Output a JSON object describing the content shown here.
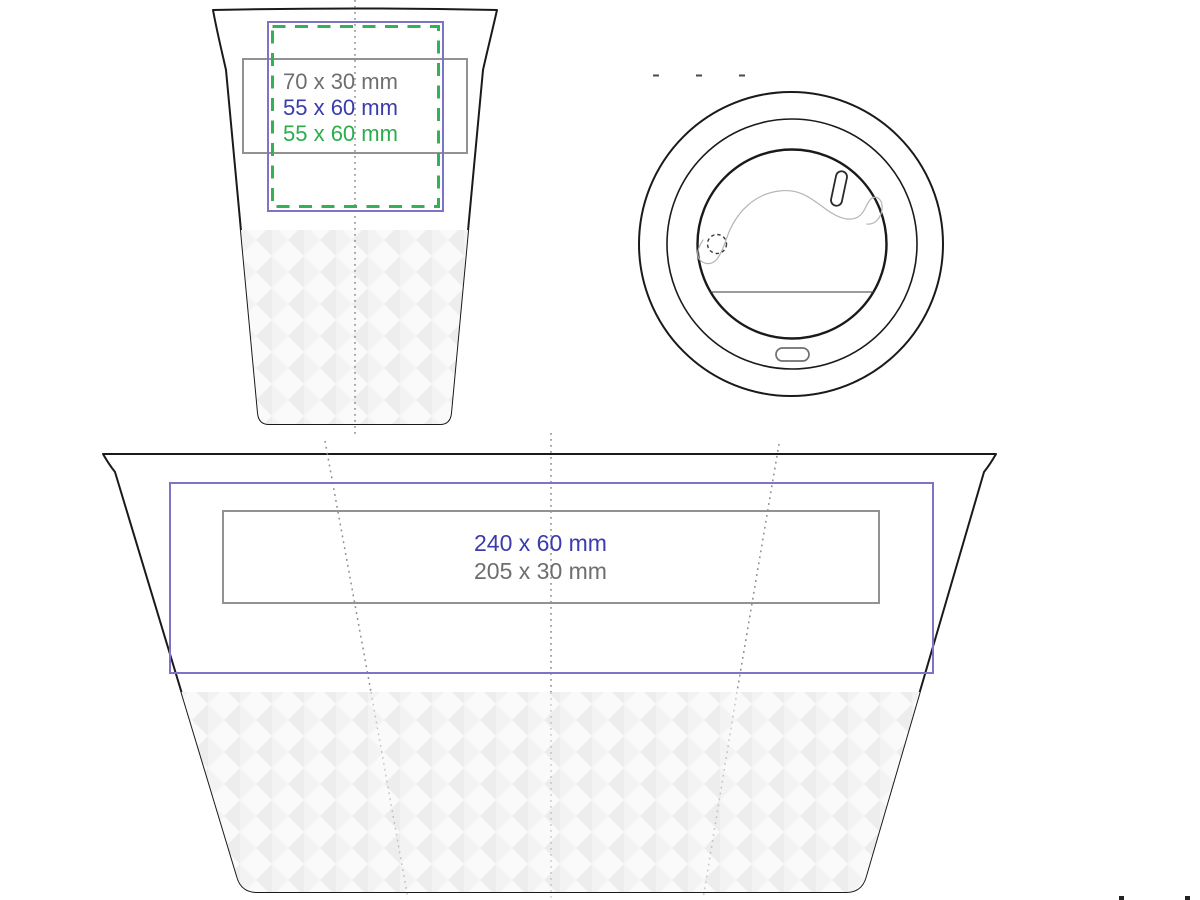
{
  "document": {
    "background": "#ffffff",
    "description_labels_only": true
  },
  "colors": {
    "outline": "#1a1a1a",
    "guide": "#8a8a8a",
    "area_gray": "#929292",
    "area_blue": "#7b74c9",
    "area_green": "#35b155",
    "text_gray": "#6e6e6e",
    "text_blue": "#3b3bae",
    "text_green": "#2bad4e",
    "detail_light": "#b5b5b5",
    "pattern_gray": "#ededed"
  },
  "front_view": {
    "labels": [
      {
        "text": "70 x 30 mm",
        "color": "#6e6e6e"
      },
      {
        "text": "55 x 60 mm",
        "color": "#3b3bae"
      },
      {
        "text": "55 x 60 mm",
        "color": "#2bad4e"
      }
    ]
  },
  "unwrapped_view": {
    "labels": [
      {
        "text": "240 x 60 mm",
        "color": "#3b3bae"
      },
      {
        "text": "205 x 30 mm",
        "color": "#6e6e6e"
      }
    ]
  }
}
